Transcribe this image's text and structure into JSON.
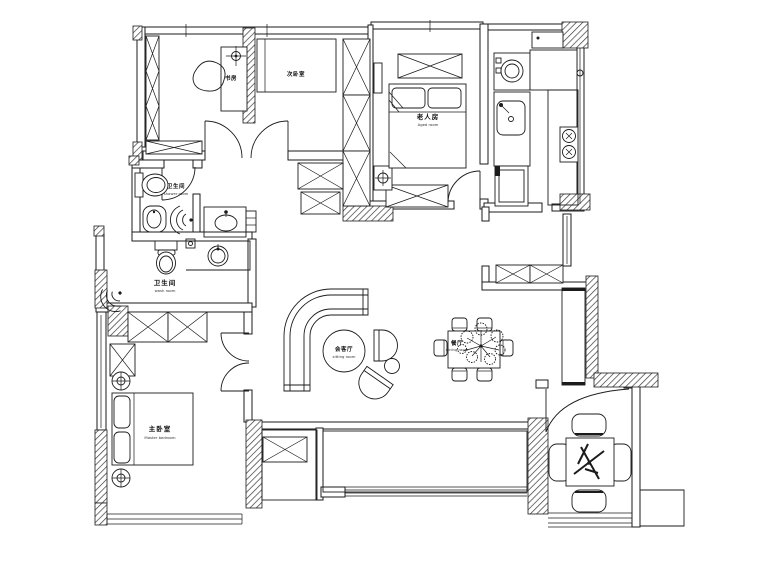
{
  "page": {
    "background": "#ffffff",
    "line_color": "#1b1b1b",
    "drawing_type": "apartment floor plan"
  },
  "rooms": {
    "study": {
      "name": "书房"
    },
    "bedroom2": {
      "name": "次卧室"
    },
    "elder_room": {
      "name": "老人房",
      "subtitle": "Aged room"
    },
    "shower_room": {
      "name": "卫生间",
      "subtitle": "shower room"
    },
    "bathroom": {
      "name": "卫生间",
      "subtitle": "wash room"
    },
    "master_bedroom": {
      "name": "主卧室",
      "subtitle": "Master bedroom"
    },
    "living_room": {
      "name": "会客厅",
      "subtitle": "sitting room"
    },
    "dining_room": {
      "name": "餐厅",
      "subtitle": "dining room"
    }
  }
}
